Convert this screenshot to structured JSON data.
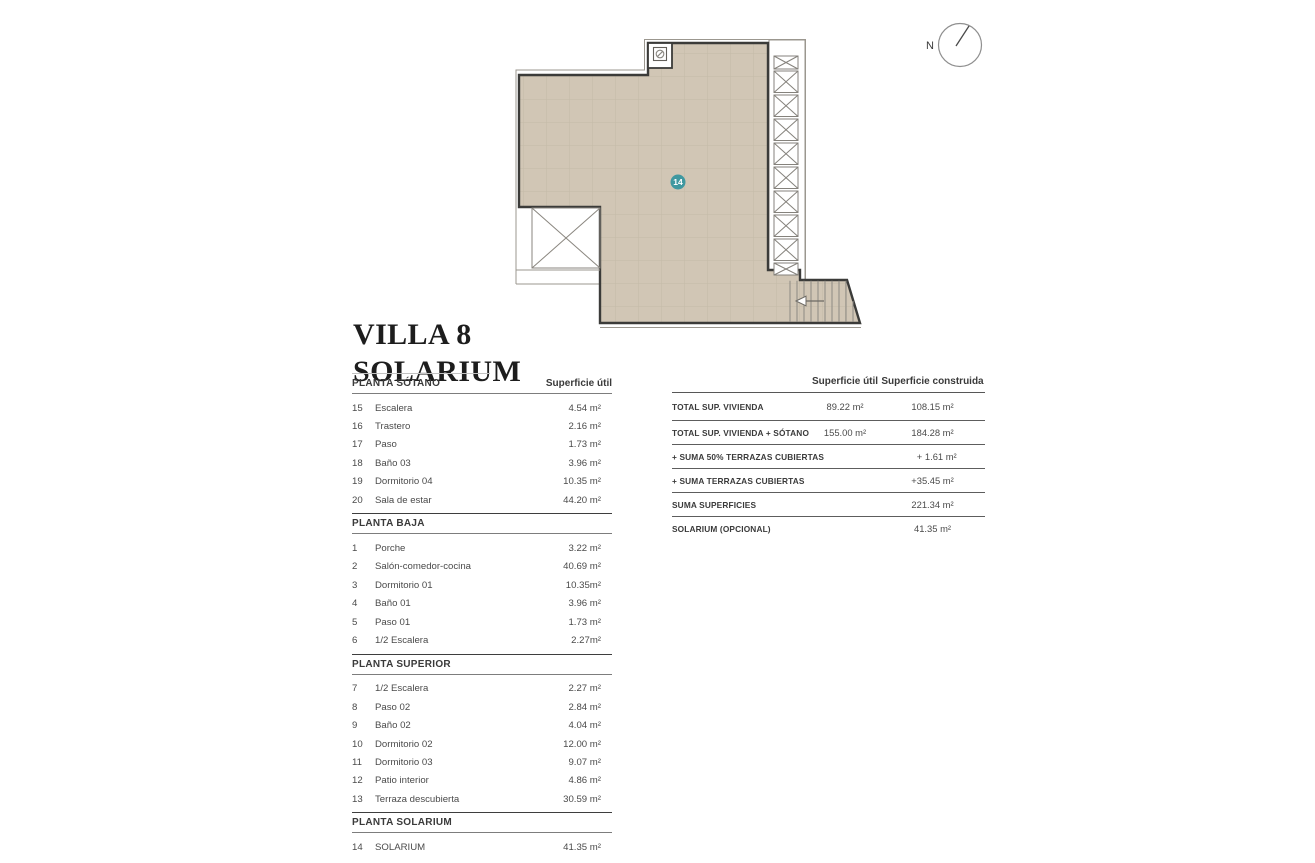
{
  "title": {
    "line1": "VILLA 8",
    "line2": "SOLARIUM"
  },
  "compass": {
    "label": "N"
  },
  "plan": {
    "marker_label": "14",
    "colors": {
      "fill": "#d1c6b5",
      "grid_line": "#c4baa8",
      "wall": "#3b3b39",
      "thin_line": "#9b978f",
      "marker": "#3f98a0"
    }
  },
  "left_table": {
    "col_header": "Superficie útil",
    "sections": [
      {
        "name": "PLANTA SÓTANO",
        "rows": [
          [
            "15",
            "Escalera",
            "4.54 m²"
          ],
          [
            "16",
            "Trastero",
            "2.16 m²"
          ],
          [
            "17",
            "Paso",
            "1.73 m²"
          ],
          [
            "18",
            "Baño 03",
            "3.96 m²"
          ],
          [
            "19",
            "Dormitorio 04",
            "10.35 m²"
          ],
          [
            "20",
            "Sala de estar",
            "44.20 m²"
          ]
        ]
      },
      {
        "name": "PLANTA BAJA",
        "rows": [
          [
            "1",
            "Porche",
            "3.22 m²"
          ],
          [
            "2",
            "Salón-comedor-cocina",
            "40.69 m²"
          ],
          [
            "3",
            "Dormitorio 01",
            "10.35m²"
          ],
          [
            "4",
            "Baño 01",
            "3.96 m²"
          ],
          [
            "5",
            "Paso 01",
            "1.73 m²"
          ],
          [
            "6",
            "1/2 Escalera",
            "2.27m²"
          ]
        ]
      },
      {
        "name": "PLANTA SUPERIOR",
        "rows": [
          [
            "7",
            "1/2 Escalera",
            "2.27 m²"
          ],
          [
            "8",
            "Paso 02",
            "2.84 m²"
          ],
          [
            "9",
            "Baño 02",
            "4.04 m²"
          ],
          [
            "10",
            "Dormitorio 02",
            "12.00 m²"
          ],
          [
            "11",
            "Dormitorio 03",
            "9.07 m²"
          ],
          [
            "12",
            "Patio interior",
            "4.86 m²"
          ],
          [
            "13",
            "Terraza descubierta",
            "30.59 m²"
          ]
        ]
      },
      {
        "name": "PLANTA SOLARIUM",
        "rows": [
          [
            "14",
            "SOLARIUM",
            "41.35 m²"
          ]
        ]
      }
    ]
  },
  "right_table": {
    "col1_header": "Superficie útil",
    "col2_header": "Superficie construida",
    "rows": [
      {
        "label": "TOTAL SUP. VIVIENDA",
        "util": "89.22 m²",
        "construida": "108.15 m²"
      },
      {
        "label": "TOTAL SUP. VIVIENDA + SÓTANO",
        "util": "155.00 m²",
        "construida": "184.28 m²"
      },
      {
        "label": "+ SUMA 50% TERRAZAS CUBIERTAS",
        "util": "",
        "construida": "+ 1.61 m²"
      },
      {
        "label": "+ SUMA TERRAZAS CUBIERTAS",
        "util": "",
        "construida": "+35.45 m²"
      },
      {
        "label": "SUMA SUPERFICIES",
        "util": "",
        "construida": "221.34 m²"
      },
      {
        "label": "SOLARIUM (OPCIONAL)",
        "util": "",
        "construida": "41.35 m²"
      }
    ]
  }
}
